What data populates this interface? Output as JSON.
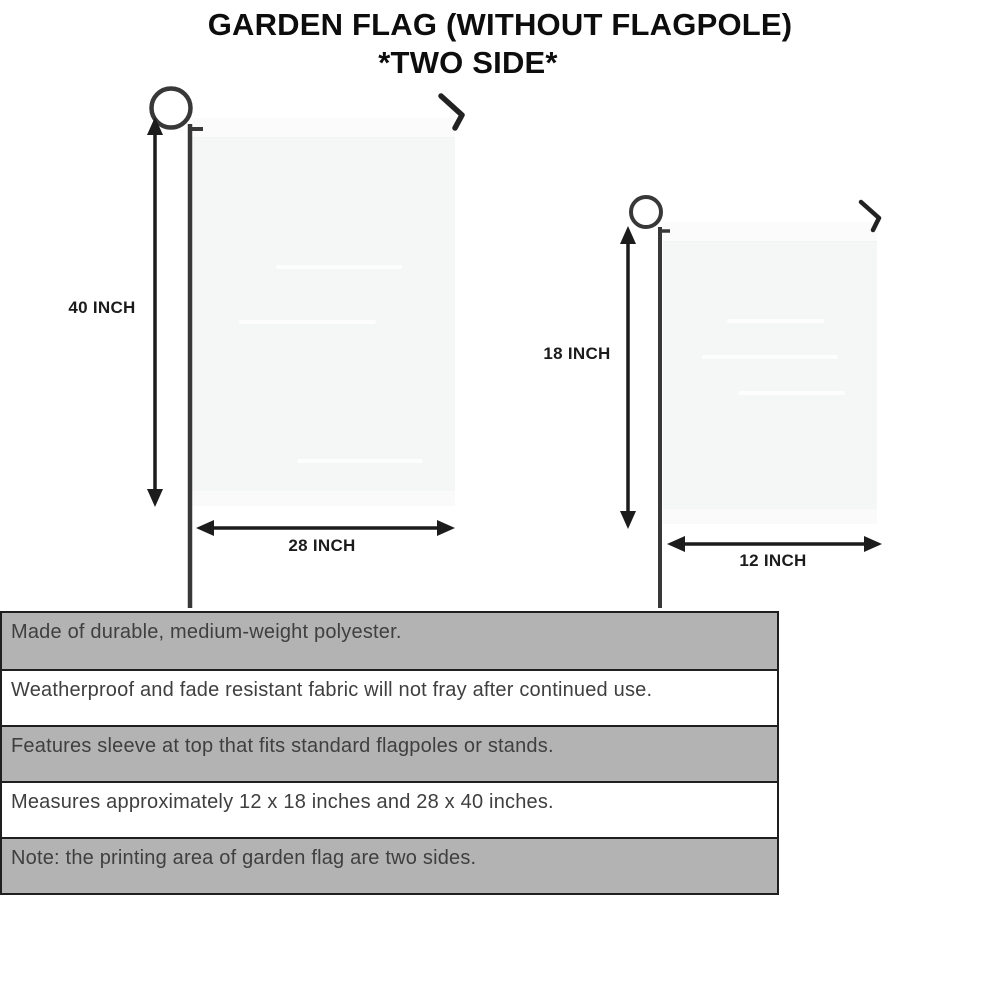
{
  "title": {
    "line1": "GARDEN FLAG (WITHOUT FLAGPOLE)",
    "line2": "*TWO SIDE*"
  },
  "diagram": {
    "large_flag": {
      "height_label": "40 INCH",
      "width_label": "28 INCH"
    },
    "small_flag": {
      "height_label": "18 INCH",
      "width_label": "12 INCH"
    }
  },
  "features": {
    "rows": [
      "Made of durable, medium-weight polyester.",
      "Weatherproof and fade resistant fabric will not fray after continued use.",
      "Features sleeve at top that fits standard flagpoles or stands.",
      "Measures approximately 12 x 18 inches and 28 x 40 inches.",
      "Note: the printing area of garden flag are two sides."
    ]
  },
  "colors": {
    "row_gray": "#b3b3b3",
    "row_white": "#ffffff",
    "table_border": "#1f1f1f",
    "flag_fill": "#f5f6f6",
    "pole": "#383838",
    "arrow": "#1c1c1c",
    "table_text": "#3f3f3f",
    "title_text": "#0d0d0d"
  }
}
